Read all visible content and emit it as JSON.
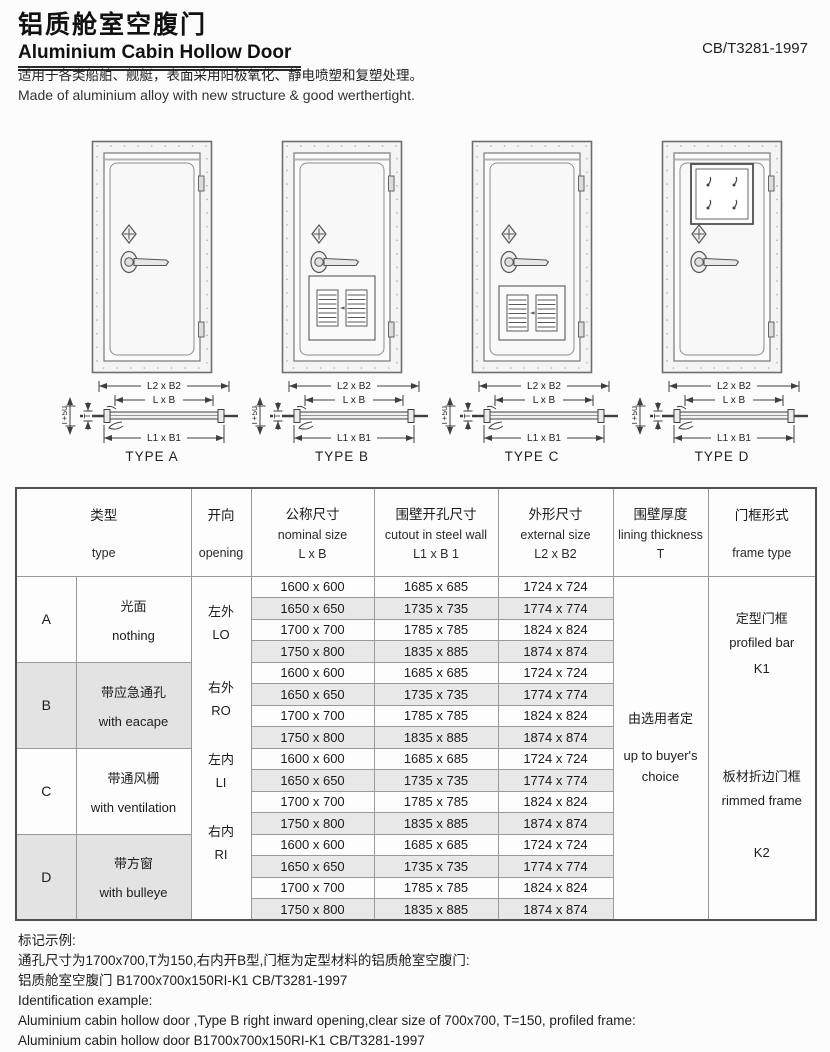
{
  "header": {
    "title_zh": "铝质舱室空腹门",
    "title_en": "Aluminium Cabin Hollow Door",
    "standard": "CB/T3281-1997",
    "desc_zh": "适用于各类船舶、舰艇，表面采用阳极氧化、静电喷塑和复塑处理。",
    "desc_en": "Made of aluminium alloy with new structure & good werthertight."
  },
  "figures": {
    "dim_outer": "L2 x B2",
    "dim_nominal": "L x B",
    "dim_cutout": "L1 x B1",
    "dim_t50": "T+50",
    "dim_t": "T",
    "captions": [
      "TYPE A",
      "TYPE B",
      "TYPE C",
      "TYPE D"
    ]
  },
  "table": {
    "headers": {
      "type_zh": "类型",
      "type_en": "type",
      "opening_zh": "开向",
      "opening_en": "opening",
      "nominal_zh": "公称尺寸",
      "nominal_en": "nominal size",
      "nominal_dim": "L x B",
      "cutout_zh": "围壁开孔尺寸",
      "cutout_en": "cutout in steel wall",
      "cutout_dim": "L1 x B 1",
      "external_zh": "外形尺寸",
      "external_en": "external  size",
      "external_dim": "L2 x B2",
      "thickness_zh": "围壁厚度",
      "thickness_en": "lining thickness",
      "thickness_dim": "T",
      "frame_zh": "门框形式",
      "frame_en": "frame type"
    },
    "types": [
      {
        "letter": "A",
        "desc_zh": "光面",
        "desc_en": "nothing"
      },
      {
        "letter": "B",
        "desc_zh": "带应急通孔",
        "desc_en": "with eacape"
      },
      {
        "letter": "C",
        "desc_zh": "带通风栅",
        "desc_en": "with ventilation"
      },
      {
        "letter": "D",
        "desc_zh": "带方窗",
        "desc_en": "with bulleye"
      }
    ],
    "openings": [
      {
        "zh": "左外",
        "en": "LO"
      },
      {
        "zh": "右外",
        "en": "RO"
      },
      {
        "zh": "左内",
        "en": "LI"
      },
      {
        "zh": "右内",
        "en": "RI"
      }
    ],
    "sizes": [
      {
        "nominal": "1600 x 600",
        "cutout": "1685 x 685",
        "external": "1724 x 724"
      },
      {
        "nominal": "1650 x 650",
        "cutout": "1735 x 735",
        "external": "1774 x 774"
      },
      {
        "nominal": "1700 x 700",
        "cutout": "1785 x 785",
        "external": "1824 x 824"
      },
      {
        "nominal": "1750 x 800",
        "cutout": "1835 x 885",
        "external": "1874 x 874"
      }
    ],
    "thickness": {
      "zh": "由选用者定",
      "en": "up to buyer's",
      "en2": "choice"
    },
    "frames": [
      {
        "zh": "定型门框",
        "en": "profiled bar",
        "code": "K1"
      },
      {
        "zh": "板材折边门框",
        "en": "rimmed frame",
        "code": "K2"
      }
    ]
  },
  "footer": {
    "heading_zh": "标记示例:",
    "line1_zh": "通孔尺寸为1700x700,T为150,右内开B型,门框为定型材料的铝质舱室空腹门:",
    "line2_zh": "铝质舱室空腹门 B1700x700x150RI-K1 CB/T3281-1997",
    "heading_en": "Identification example:",
    "line1_en": "Aluminium cabin hollow door ,Type B right inward opening,clear size of 700x700, T=150, profiled frame:",
    "line2_en": "Aluminium cabin hollow door B1700x700x150RI-K1 CB/T3281-1997"
  }
}
